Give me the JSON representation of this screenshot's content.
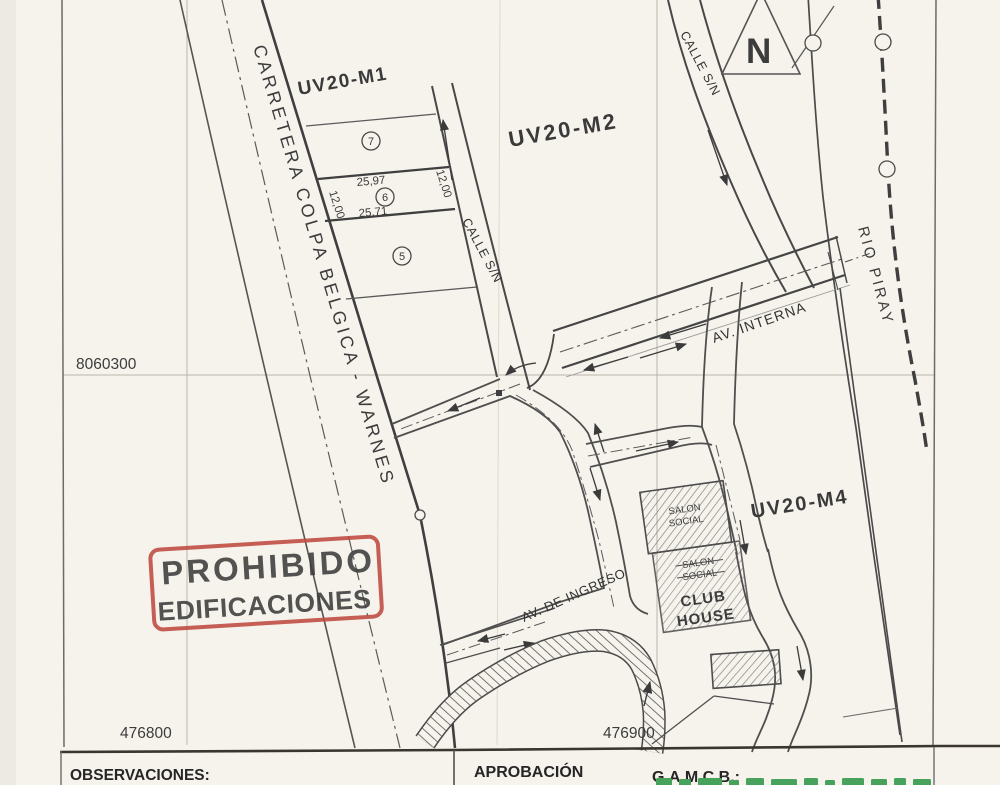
{
  "colors": {
    "stamp_red": "#bf4a41",
    "logo_green": "#47a35c",
    "paper": "#f6f3ec",
    "ink": "#3c3c3c"
  },
  "map": {
    "north_label": "N",
    "grid": {
      "northing": "8060300",
      "easting_left": "476800",
      "easting_right": "476900"
    },
    "blocks": {
      "m1": "UV20-M1",
      "m2": "UV20-M2",
      "m4": "UV20-M4"
    },
    "roads": {
      "carretera": "CARRETERA COLPA BELGICA - WARNES",
      "calle_mid": "CALLE S/N",
      "calle_top": "CALLE S/N",
      "av_interna": "AV. INTERNA",
      "av_ingreso": "AV. DE INGRESO"
    },
    "river": "RIO PIRAY",
    "lots": {
      "n5": "5",
      "n6": "6",
      "n7": "7"
    },
    "dims": {
      "w_top": "25,97",
      "w_bottom": "25,71",
      "h_left": "12,00",
      "h_right": "12,00"
    },
    "buildings": {
      "salon_w1": "SALON",
      "salon_w2": "SOCIAL",
      "club_w1": "CLUB",
      "club_w2": "HOUSE"
    },
    "stamp": {
      "line1": "PROHIBIDO",
      "line2": "EDIFICACIONES"
    }
  },
  "footer": {
    "observaciones": "OBSERVACIONES:",
    "aprobacion": "APROBACIÓN",
    "gamcb": "G.A.M.C.B.:"
  }
}
